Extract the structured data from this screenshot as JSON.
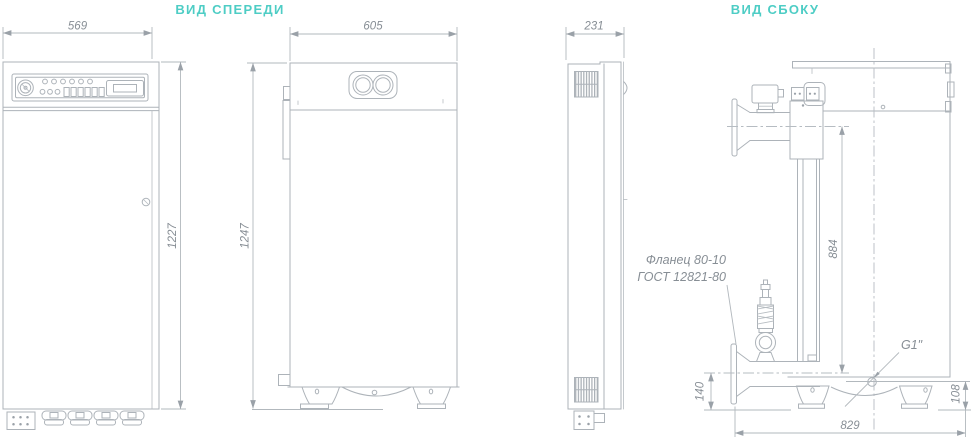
{
  "drawing": {
    "views": {
      "front": {
        "title": "ВИД СПЕРЕДИ"
      },
      "side": {
        "title": "ВИД СБОКУ"
      }
    },
    "dimensions_mm": {
      "control_cabinet_width": "569",
      "control_cabinet_height": "1227",
      "boiler_width": "605",
      "boiler_height": "1247",
      "boiler_depth": "231",
      "flange_axis_span": "884",
      "lower_pipe_axis_height": "140",
      "drain_axis_height": "108",
      "base_depth": "829"
    },
    "annotations": {
      "flange_note_line1": "Фланец 80-10",
      "flange_note_line2": "ГОСТ 12821-80",
      "drain_connection": "G1\""
    },
    "colors": {
      "title_teal": "#4ecdc5",
      "object_line_gray": "#adb3b9",
      "dimension_text_gray": "#878e95",
      "background": "#ffffff"
    }
  }
}
